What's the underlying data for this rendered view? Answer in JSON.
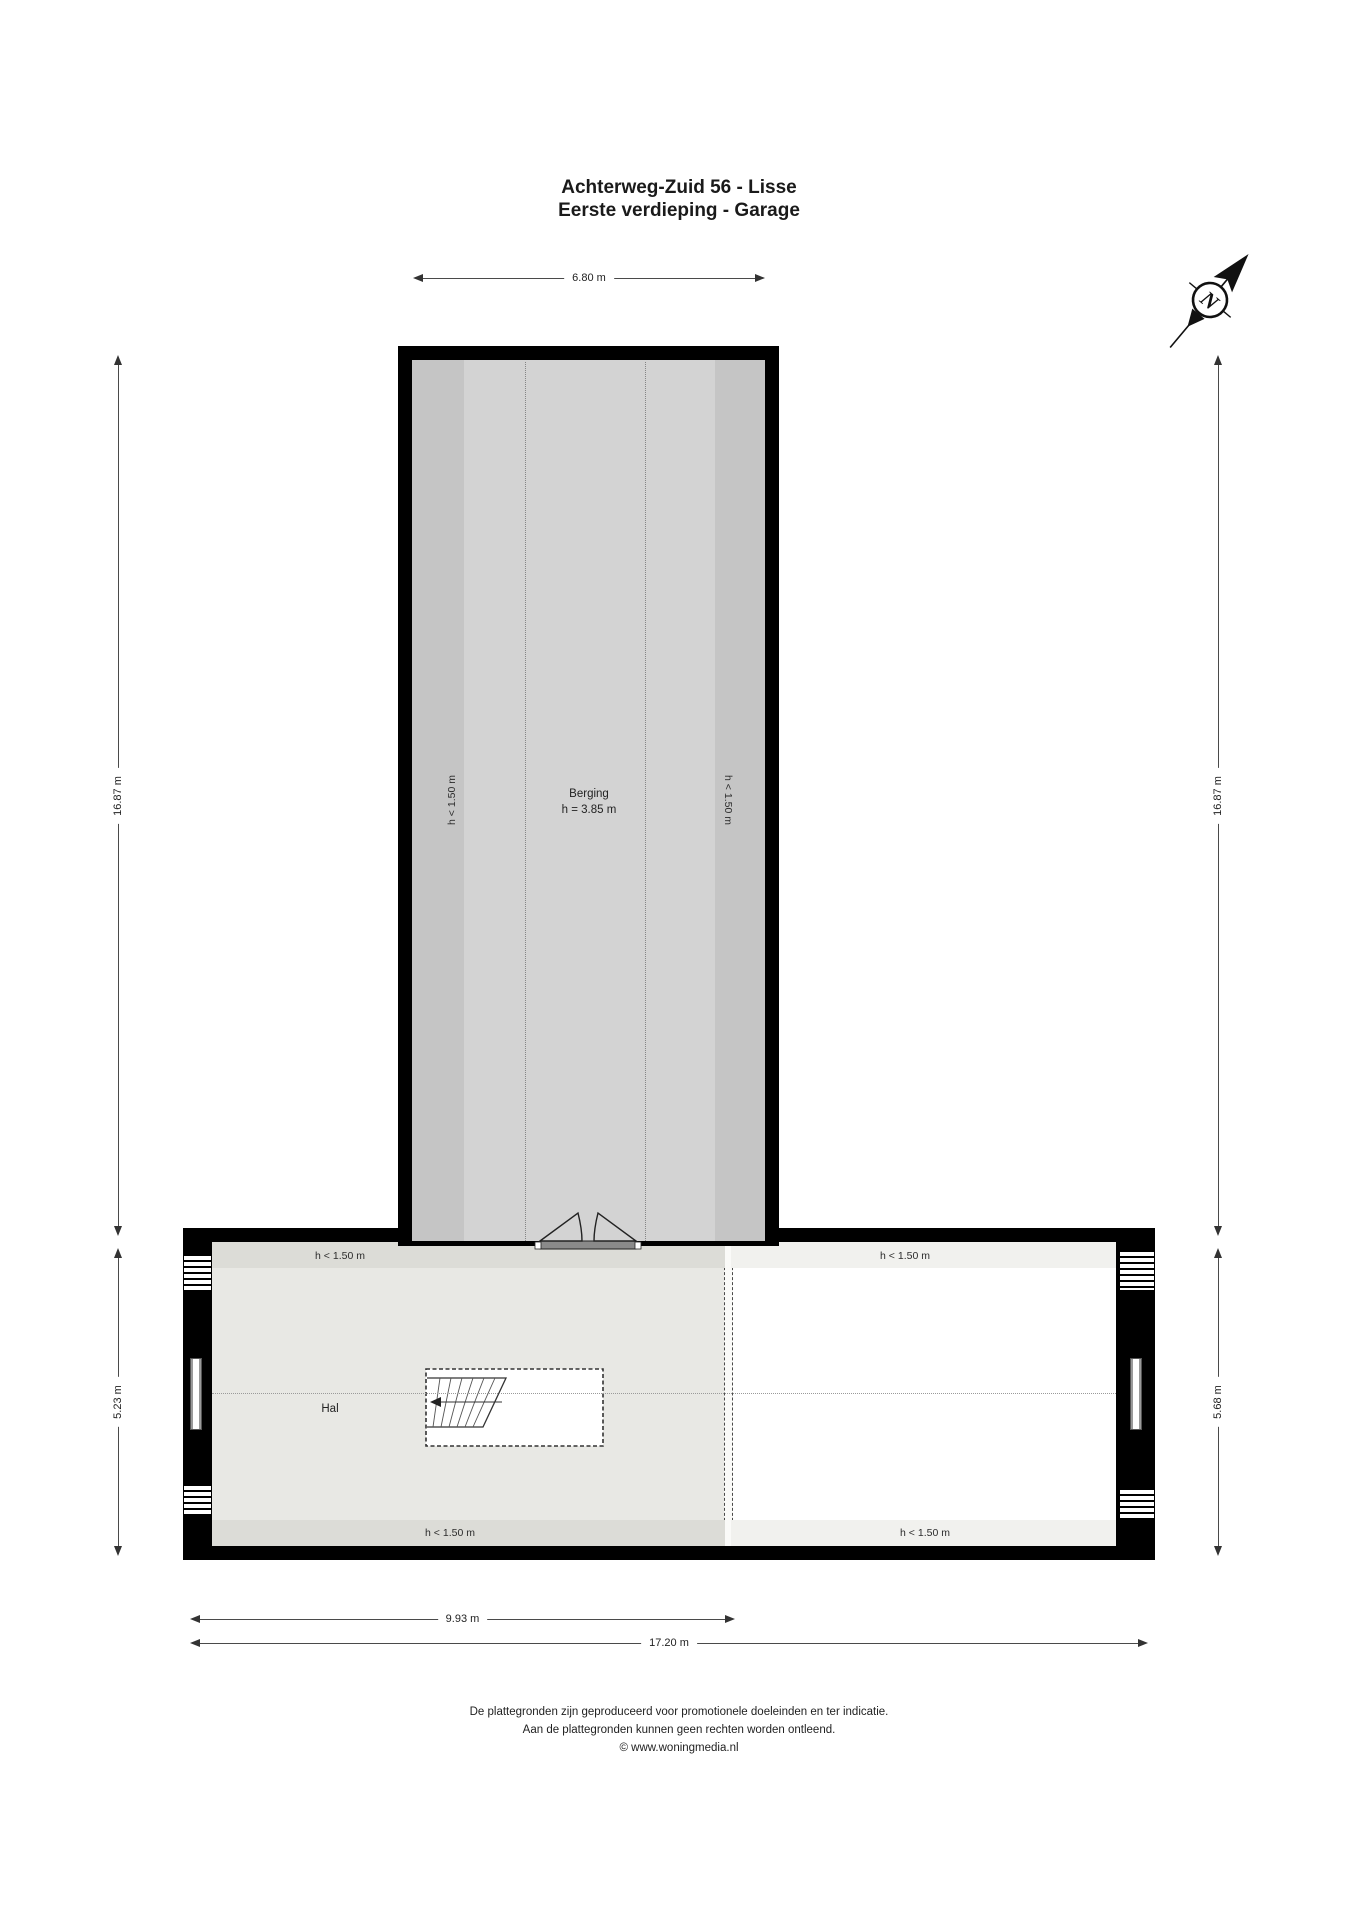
{
  "title": {
    "line1": "Achterweg-Zuid 56 - Lisse",
    "line2": "Eerste verdieping - Garage"
  },
  "compass": {
    "north_label": "N"
  },
  "dimensions": {
    "top_width": "6.80 m",
    "left_upper": "16.87 m",
    "left_lower": "5.23 m",
    "right_upper": "16.87 m",
    "right_lower": "5.68 m",
    "bottom_hal_width": "9.93 m",
    "bottom_total_width": "17.20 m"
  },
  "berging": {
    "name": "Berging",
    "ceiling_height": "h = 3.85 m",
    "low_zone_left": "h < 1.50 m",
    "low_zone_right": "h < 1.50 m"
  },
  "hal": {
    "name": "Hal",
    "low_zone_top": "h < 1.50 m",
    "low_zone_bottom": "h < 1.50 m"
  },
  "attic_right": {
    "low_zone_top": "h < 1.50 m",
    "low_zone_bottom": "h < 1.50 m"
  },
  "footer": {
    "line1": "De plattegronden zijn geproduceerd voor promotionele doeleinden en ter indicatie.",
    "line2": "Aan de plattegronden kunnen geen rechten worden ontleend.",
    "line3": "© www.woningmedia.nl"
  },
  "colors": {
    "wall": "#000000",
    "berging_fill": "#d3d3d3",
    "berging_low_zone": "#c5c5c5",
    "hal_fill": "#e8e8e4",
    "hal_low_zone": "#dcdcd7",
    "right_fill": "#ffffff",
    "right_low_zone": "#f1f1ee",
    "door_threshold": "#8a8a8a"
  }
}
